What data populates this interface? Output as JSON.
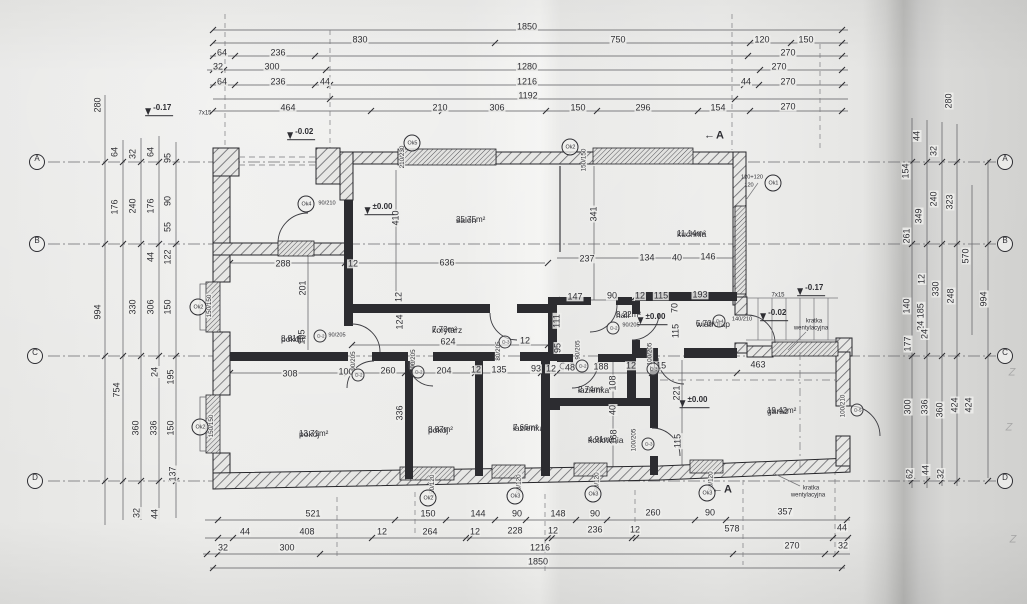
{
  "colors": {
    "ink": "#2e2e33",
    "paper": "#ebebe9"
  },
  "rooms": [
    {
      "name": "salon",
      "area": "35.75m²",
      "x": 456,
      "y": 216
    },
    {
      "name": "kuchnia",
      "area": "11.14m²",
      "x": 677,
      "y": 230
    },
    {
      "name": "pokój",
      "area": "8.81m²",
      "x": 281,
      "y": 335
    },
    {
      "name": "korytarz",
      "area": "7.73m²",
      "x": 432,
      "y": 326
    },
    {
      "name": "hall",
      "area": "3.22m²",
      "x": 616,
      "y": 311
    },
    {
      "name": "wiatrołap",
      "area": "5.70m²",
      "x": 696,
      "y": 320
    },
    {
      "name": "pokój",
      "area": "13.71m²",
      "x": 299,
      "y": 430
    },
    {
      "name": "pokój",
      "area": "8.87m²",
      "x": 428,
      "y": 426
    },
    {
      "name": "łazienka",
      "area": "7.66m²",
      "x": 513,
      "y": 424
    },
    {
      "name": "łazienka",
      "area": "2.74m²",
      "x": 578,
      "y": 386
    },
    {
      "name": "kotłownia",
      "area": "4.91m²",
      "x": 588,
      "y": 436
    },
    {
      "name": "garaż",
      "area": "19.42m²",
      "x": 767,
      "y": 407
    }
  ],
  "dims": {
    "horizontal": [
      {
        "t": "1850",
        "x": 527,
        "y": 27
      },
      {
        "t": "830",
        "x": 360,
        "y": 40
      },
      {
        "t": "750",
        "x": 618,
        "y": 40
      },
      {
        "t": "120",
        "x": 762,
        "y": 40
      },
      {
        "t": "150",
        "x": 806,
        "y": 40
      },
      {
        "t": "64",
        "x": 222,
        "y": 53
      },
      {
        "t": "236",
        "x": 278,
        "y": 53
      },
      {
        "t": "270",
        "x": 788,
        "y": 53
      },
      {
        "t": "32",
        "x": 218,
        "y": 67
      },
      {
        "t": "300",
        "x": 272,
        "y": 67
      },
      {
        "t": "1280",
        "x": 527,
        "y": 67
      },
      {
        "t": "270",
        "x": 779,
        "y": 67
      },
      {
        "t": "64",
        "x": 222,
        "y": 82
      },
      {
        "t": "236",
        "x": 278,
        "y": 82
      },
      {
        "t": "44",
        "x": 325,
        "y": 82
      },
      {
        "t": "1216",
        "x": 527,
        "y": 82
      },
      {
        "t": "44",
        "x": 746,
        "y": 82
      },
      {
        "t": "270",
        "x": 788,
        "y": 82
      },
      {
        "t": "1192",
        "x": 528,
        "y": 96
      },
      {
        "t": "464",
        "x": 288,
        "y": 108
      },
      {
        "t": "210",
        "x": 440,
        "y": 108
      },
      {
        "t": "306",
        "x": 497,
        "y": 108
      },
      {
        "t": "150",
        "x": 578,
        "y": 108
      },
      {
        "t": "296",
        "x": 643,
        "y": 108
      },
      {
        "t": "154",
        "x": 718,
        "y": 108
      },
      {
        "t": "270",
        "x": 788,
        "y": 107
      },
      {
        "t": "288",
        "x": 283,
        "y": 264
      },
      {
        "t": "12",
        "x": 353,
        "y": 264
      },
      {
        "t": "636",
        "x": 447,
        "y": 263
      },
      {
        "t": "237",
        "x": 587,
        "y": 259
      },
      {
        "t": "134",
        "x": 647,
        "y": 258
      },
      {
        "t": "40",
        "x": 677,
        "y": 258
      },
      {
        "t": "146",
        "x": 708,
        "y": 257
      },
      {
        "t": "147",
        "x": 575,
        "y": 297
      },
      {
        "t": "90",
        "x": 612,
        "y": 296
      },
      {
        "t": "12",
        "x": 640,
        "y": 296
      },
      {
        "t": "115",
        "x": 661,
        "y": 296
      },
      {
        "t": "193",
        "x": 700,
        "y": 295
      },
      {
        "t": "624",
        "x": 448,
        "y": 342
      },
      {
        "t": "12",
        "x": 525,
        "y": 341
      },
      {
        "t": "308",
        "x": 290,
        "y": 374
      },
      {
        "t": "100",
        "x": 346,
        "y": 372
      },
      {
        "t": "260",
        "x": 388,
        "y": 371
      },
      {
        "t": "204",
        "x": 444,
        "y": 371
      },
      {
        "t": "12",
        "x": 476,
        "y": 370
      },
      {
        "t": "135",
        "x": 499,
        "y": 370
      },
      {
        "t": "93",
        "x": 536,
        "y": 369
      },
      {
        "t": "12",
        "x": 551,
        "y": 369
      },
      {
        "t": "48",
        "x": 570,
        "y": 368
      },
      {
        "t": "188",
        "x": 601,
        "y": 367
      },
      {
        "t": "12",
        "x": 631,
        "y": 366
      },
      {
        "t": "115",
        "x": 659,
        "y": 366
      },
      {
        "t": "463",
        "x": 758,
        "y": 365
      },
      {
        "t": "521",
        "x": 313,
        "y": 514
      },
      {
        "t": "150",
        "x": 428,
        "y": 514
      },
      {
        "t": "144",
        "x": 478,
        "y": 514
      },
      {
        "t": "90",
        "x": 517,
        "y": 514
      },
      {
        "t": "148",
        "x": 558,
        "y": 514
      },
      {
        "t": "90",
        "x": 595,
        "y": 514
      },
      {
        "t": "260",
        "x": 653,
        "y": 513
      },
      {
        "t": "90",
        "x": 710,
        "y": 513
      },
      {
        "t": "357",
        "x": 785,
        "y": 512
      },
      {
        "t": "44",
        "x": 245,
        "y": 532
      },
      {
        "t": "408",
        "x": 307,
        "y": 532
      },
      {
        "t": "12",
        "x": 382,
        "y": 532
      },
      {
        "t": "264",
        "x": 430,
        "y": 532
      },
      {
        "t": "12",
        "x": 475,
        "y": 532
      },
      {
        "t": "228",
        "x": 515,
        "y": 531
      },
      {
        "t": "12",
        "x": 553,
        "y": 531
      },
      {
        "t": "236",
        "x": 595,
        "y": 530
      },
      {
        "t": "12",
        "x": 635,
        "y": 530
      },
      {
        "t": "578",
        "x": 732,
        "y": 529
      },
      {
        "t": "44",
        "x": 842,
        "y": 528
      },
      {
        "t": "32",
        "x": 223,
        "y": 548
      },
      {
        "t": "300",
        "x": 287,
        "y": 548
      },
      {
        "t": "1216",
        "x": 540,
        "y": 548
      },
      {
        "t": "270",
        "x": 792,
        "y": 546
      },
      {
        "t": "32",
        "x": 843,
        "y": 546
      },
      {
        "t": "1850",
        "x": 538,
        "y": 562
      }
    ],
    "vertical": [
      {
        "t": "280",
        "x": 98,
        "y": 105
      },
      {
        "t": "64",
        "x": 115,
        "y": 152
      },
      {
        "t": "32",
        "x": 133,
        "y": 154
      },
      {
        "t": "64",
        "x": 151,
        "y": 152
      },
      {
        "t": "95",
        "x": 168,
        "y": 158
      },
      {
        "t": "176",
        "x": 115,
        "y": 207
      },
      {
        "t": "240",
        "x": 133,
        "y": 206
      },
      {
        "t": "176",
        "x": 151,
        "y": 206
      },
      {
        "t": "90",
        "x": 168,
        "y": 201
      },
      {
        "t": "55",
        "x": 168,
        "y": 227
      },
      {
        "t": "44",
        "x": 151,
        "y": 257
      },
      {
        "t": "122",
        "x": 168,
        "y": 257
      },
      {
        "t": "994",
        "x": 98,
        "y": 312
      },
      {
        "t": "330",
        "x": 133,
        "y": 307
      },
      {
        "t": "306",
        "x": 151,
        "y": 307
      },
      {
        "t": "150",
        "x": 168,
        "y": 307
      },
      {
        "t": "754",
        "x": 117,
        "y": 390
      },
      {
        "t": "24",
        "x": 155,
        "y": 372
      },
      {
        "t": "195",
        "x": 171,
        "y": 377
      },
      {
        "t": "360",
        "x": 136,
        "y": 428
      },
      {
        "t": "336",
        "x": 154,
        "y": 428
      },
      {
        "t": "150",
        "x": 171,
        "y": 428
      },
      {
        "t": "137",
        "x": 173,
        "y": 474
      },
      {
        "t": "32",
        "x": 137,
        "y": 513
      },
      {
        "t": "44",
        "x": 155,
        "y": 514
      },
      {
        "t": "280",
        "x": 949,
        "y": 101
      },
      {
        "t": "44",
        "x": 917,
        "y": 136
      },
      {
        "t": "32",
        "x": 934,
        "y": 151
      },
      {
        "t": "154",
        "x": 906,
        "y": 171
      },
      {
        "t": "240",
        "x": 934,
        "y": 199
      },
      {
        "t": "323",
        "x": 950,
        "y": 202
      },
      {
        "t": "349",
        "x": 919,
        "y": 216
      },
      {
        "t": "261",
        "x": 907,
        "y": 236
      },
      {
        "t": "570",
        "x": 966,
        "y": 256
      },
      {
        "t": "12",
        "x": 922,
        "y": 279
      },
      {
        "t": "330",
        "x": 936,
        "y": 289
      },
      {
        "t": "248",
        "x": 951,
        "y": 296
      },
      {
        "t": "994",
        "x": 984,
        "y": 299
      },
      {
        "t": "140",
        "x": 907,
        "y": 306
      },
      {
        "t": "24 185",
        "x": 921,
        "y": 317
      },
      {
        "t": "177",
        "x": 908,
        "y": 344
      },
      {
        "t": "24",
        "x": 925,
        "y": 334
      },
      {
        "t": "300",
        "x": 908,
        "y": 407
      },
      {
        "t": "336",
        "x": 925,
        "y": 407
      },
      {
        "t": "360",
        "x": 940,
        "y": 410
      },
      {
        "t": "424",
        "x": 955,
        "y": 405
      },
      {
        "t": "424",
        "x": 969,
        "y": 405
      },
      {
        "t": "62",
        "x": 910,
        "y": 474
      },
      {
        "t": "44",
        "x": 926,
        "y": 470
      },
      {
        "t": "32",
        "x": 941,
        "y": 474
      },
      {
        "t": "410",
        "x": 396,
        "y": 218
      },
      {
        "t": "341",
        "x": 594,
        "y": 214
      },
      {
        "t": "201",
        "x": 303,
        "y": 288
      },
      {
        "t": "105",
        "x": 302,
        "y": 337
      },
      {
        "t": "12",
        "x": 399,
        "y": 297
      },
      {
        "t": "124",
        "x": 400,
        "y": 322
      },
      {
        "t": "111",
        "x": 557,
        "y": 321
      },
      {
        "t": "95",
        "x": 558,
        "y": 348
      },
      {
        "t": "70",
        "x": 675,
        "y": 308
      },
      {
        "t": "115",
        "x": 676,
        "y": 331
      },
      {
        "t": "108",
        "x": 613,
        "y": 383
      },
      {
        "t": "40",
        "x": 613,
        "y": 410
      },
      {
        "t": "168",
        "x": 614,
        "y": 437
      },
      {
        "t": "221",
        "x": 677,
        "y": 393
      },
      {
        "t": "115",
        "x": 678,
        "y": 441
      },
      {
        "t": "336",
        "x": 400,
        "y": 413
      }
    ],
    "tiny": [
      {
        "t": "150/150",
        "x": 584,
        "y": 160,
        "r": 1
      },
      {
        "t": "210/230",
        "x": 402,
        "y": 157,
        "r": 1
      },
      {
        "t": "150/150",
        "x": 209,
        "y": 306,
        "r": 1
      },
      {
        "t": "150/150",
        "x": 211,
        "y": 426,
        "r": 1
      },
      {
        "t": "150/120",
        "x": 432,
        "y": 486,
        "r": 1
      },
      {
        "t": "90/120",
        "x": 519,
        "y": 484,
        "r": 1
      },
      {
        "t": "90/120",
        "x": 597,
        "y": 482,
        "r": 1
      },
      {
        "t": "90/120",
        "x": 711,
        "y": 481,
        "r": 1
      },
      {
        "t": "90/210",
        "x": 327,
        "y": 203,
        "r": 0
      },
      {
        "t": "120+120",
        "x": 752,
        "y": 177,
        "r": 0
      },
      {
        "t": "120",
        "x": 749,
        "y": 185,
        "r": 0
      },
      {
        "t": "90/205",
        "x": 337,
        "y": 335,
        "r": 0
      },
      {
        "t": "90/205",
        "x": 353,
        "y": 361,
        "r": 1
      },
      {
        "t": "90/205",
        "x": 413,
        "y": 359,
        "r": 1
      },
      {
        "t": "80/205",
        "x": 498,
        "y": 351,
        "r": 1
      },
      {
        "t": "90/205",
        "x": 631,
        "y": 325,
        "r": 0
      },
      {
        "t": "90/205",
        "x": 578,
        "y": 350,
        "r": 1
      },
      {
        "t": "100/205",
        "x": 650,
        "y": 354,
        "r": 1
      },
      {
        "t": "100/205",
        "x": 634,
        "y": 440,
        "r": 1
      },
      {
        "t": "140/210",
        "x": 742,
        "y": 319,
        "r": 0
      },
      {
        "t": "100/210",
        "x": 843,
        "y": 406,
        "r": 1
      }
    ]
  },
  "annotations": [
    {
      "t": "kratka",
      "x": 814,
      "y": 321
    },
    {
      "t": "wentylacyjna",
      "x": 811,
      "y": 328
    },
    {
      "t": "kratka",
      "x": 811,
      "y": 488
    },
    {
      "t": "wentylacyjna",
      "x": 808,
      "y": 495
    },
    {
      "t": "7x15",
      "x": 778,
      "y": 295
    },
    {
      "t": "7x15",
      "x": 205,
      "y": 113
    }
  ],
  "grid_markers": [
    {
      "l": "A",
      "x": 37,
      "y": 162
    },
    {
      "l": "B",
      "x": 37,
      "y": 244
    },
    {
      "l": "C",
      "x": 35,
      "y": 356
    },
    {
      "l": "D",
      "x": 35,
      "y": 481
    },
    {
      "l": "A",
      "x": 1005,
      "y": 162
    },
    {
      "l": "B",
      "x": 1005,
      "y": 244
    },
    {
      "l": "C",
      "x": 1005,
      "y": 356
    },
    {
      "l": "D",
      "x": 1005,
      "y": 481
    }
  ],
  "window_markers": [
    {
      "id": "Ok2",
      "x": 570,
      "y": 147
    },
    {
      "id": "Ok5",
      "x": 412,
      "y": 143
    },
    {
      "id": "Ok1",
      "x": 773,
      "y": 183
    },
    {
      "id": "Ok4",
      "x": 306,
      "y": 204
    },
    {
      "id": "Ok2",
      "x": 198,
      "y": 307
    },
    {
      "id": "Ok2",
      "x": 200,
      "y": 427
    },
    {
      "id": "Ok2",
      "x": 428,
      "y": 498
    },
    {
      "id": "Ok3",
      "x": 515,
      "y": 496
    },
    {
      "id": "Ok3",
      "x": 593,
      "y": 494
    },
    {
      "id": "Ok3",
      "x": 707,
      "y": 493
    }
  ],
  "door_markers": [
    {
      "id": "D-2",
      "x": 320,
      "y": 336
    },
    {
      "id": "D-2",
      "x": 358,
      "y": 375
    },
    {
      "id": "D-2",
      "x": 418,
      "y": 372
    },
    {
      "id": "D-3",
      "x": 505,
      "y": 342
    },
    {
      "id": "D-2",
      "x": 613,
      "y": 328
    },
    {
      "id": "D-2",
      "x": 582,
      "y": 366
    },
    {
      "id": "D-3",
      "x": 653,
      "y": 369
    },
    {
      "id": "D-3",
      "x": 648,
      "y": 444
    },
    {
      "id": "D-4",
      "x": 719,
      "y": 321
    },
    {
      "id": "D-5",
      "x": 857,
      "y": 410
    }
  ],
  "levels": [
    {
      "t": "-0.17",
      "x": 155,
      "y": 112
    },
    {
      "t": "-0.02",
      "x": 297,
      "y": 136
    },
    {
      "t": "±0.00",
      "x": 375,
      "y": 211
    },
    {
      "t": "±0.00",
      "x": 648,
      "y": 321
    },
    {
      "t": "-0.02",
      "x": 770,
      "y": 317
    },
    {
      "t": "-0.17",
      "x": 807,
      "y": 292
    },
    {
      "t": "±0.00",
      "x": 690,
      "y": 404
    }
  ],
  "sections": [
    {
      "t": "A",
      "x": 714,
      "y": 136
    },
    {
      "t": "A",
      "x": 722,
      "y": 490
    }
  ],
  "artifacts": [
    {
      "t": "Z",
      "x": 1012,
      "y": 373
    },
    {
      "t": "Z",
      "x": 1009,
      "y": 428
    },
    {
      "t": "Z",
      "x": 1013,
      "y": 540
    }
  ]
}
